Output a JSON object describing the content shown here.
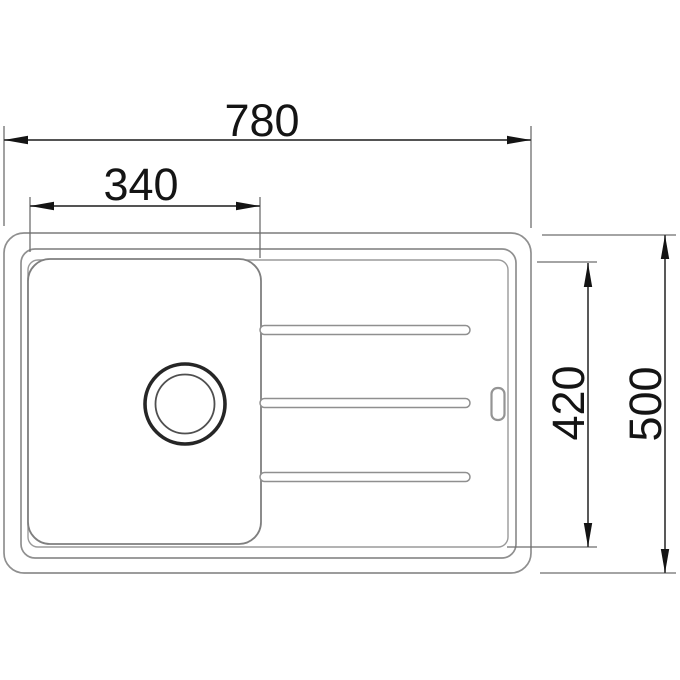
{
  "diagram": {
    "kind": "sink-top-view-dimension-drawing",
    "dimensions": {
      "overall_width": "780",
      "bowl_width": "340",
      "inner_depth": "420",
      "overall_depth": "500"
    },
    "colors": {
      "background": "#ffffff",
      "drawing_outline": "#8f8f8f",
      "drain_outline": "#262626",
      "dimension_line": "#3c3c3c",
      "dimension_text": "#141414"
    }
  }
}
